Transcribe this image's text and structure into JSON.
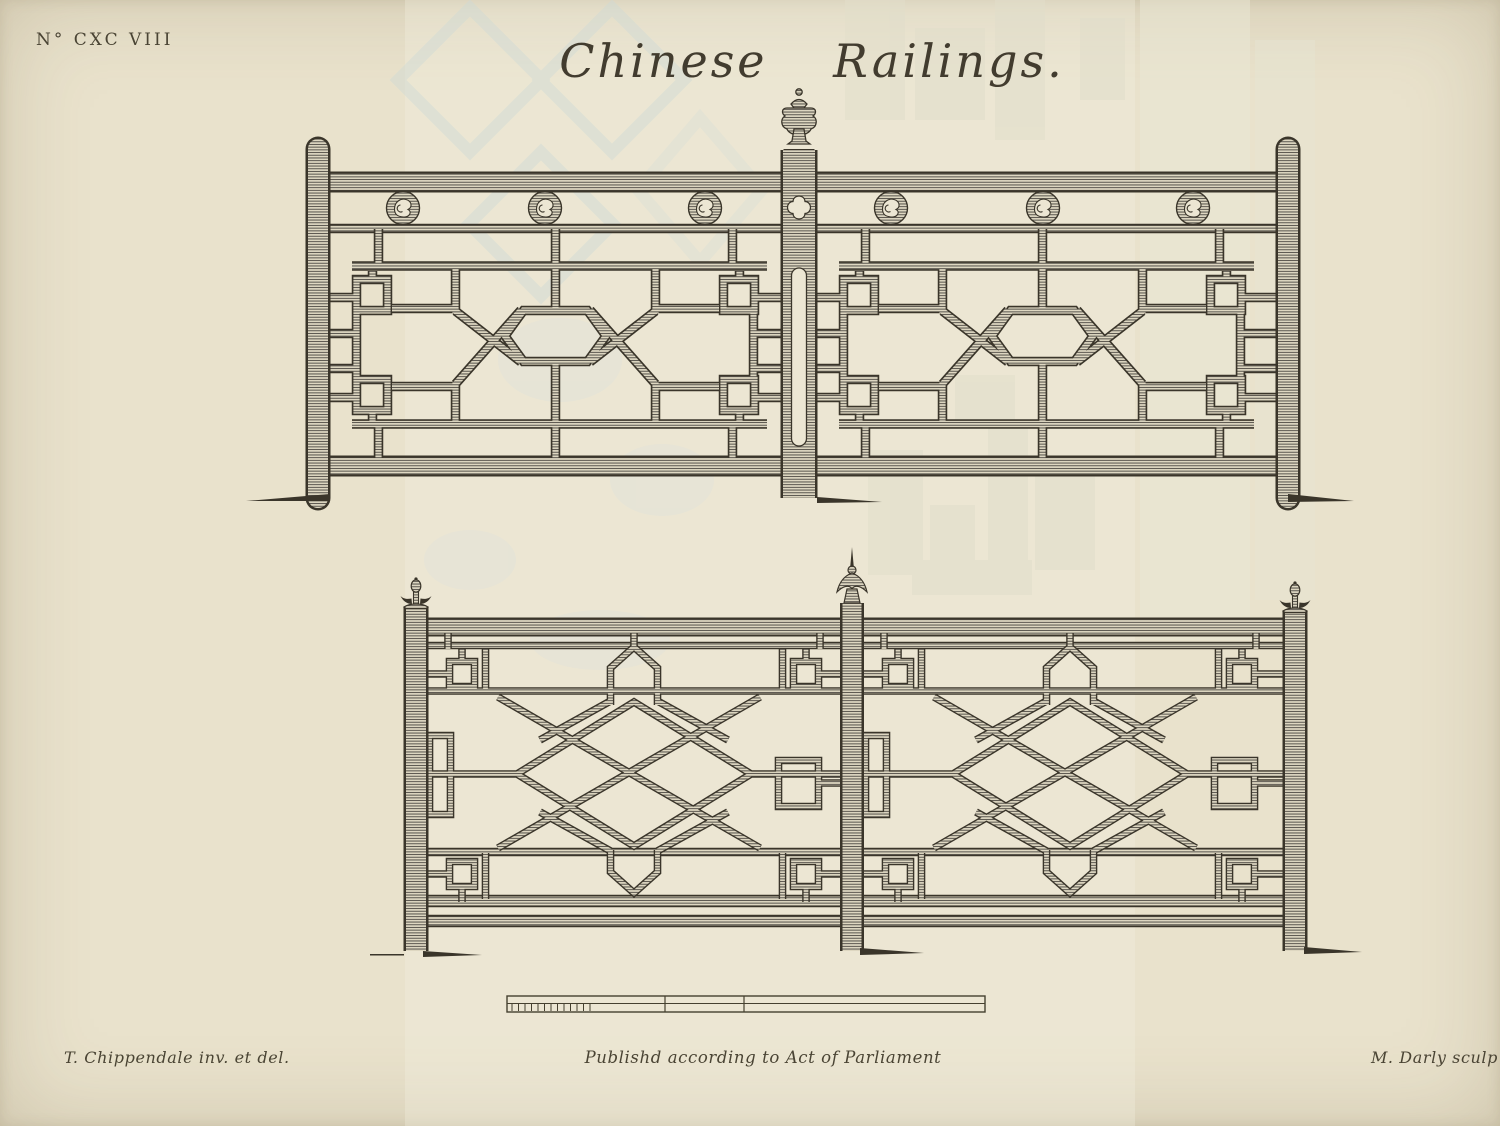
{
  "plate": {
    "number": "N° CXC VIII",
    "title": "Chinese Railings.",
    "credits": {
      "left": "T. Chippendale inv. et del.",
      "center": "Publishd according to Act of Parliament",
      "right": "M. Darly sculp"
    },
    "colors": {
      "paper": "#e9e2cc",
      "ink": "#3a352a",
      "hatch_line": "#55514a",
      "ghost_cool": "#cfdad6",
      "ghost_warm": "#e1decb"
    },
    "figures": {
      "top_railing": "fret railing with medallion frieze and urn finial",
      "bottom_railing": "lattice railing with spike finials",
      "scale_bar": "scale"
    }
  }
}
